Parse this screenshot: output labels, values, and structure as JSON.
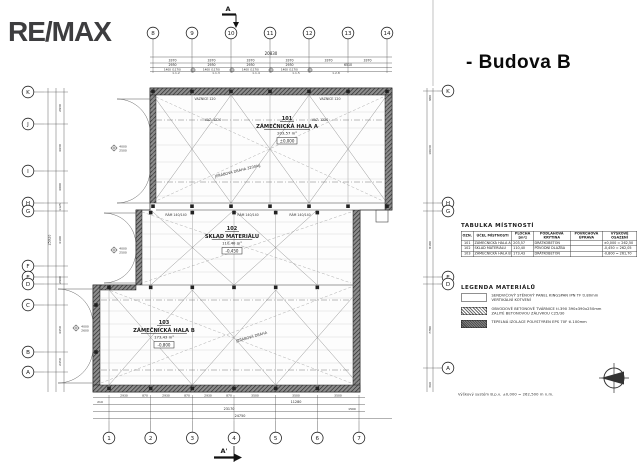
{
  "logo": {
    "text": "RE/MAX"
  },
  "title": "- Budova B",
  "note": "Výškový systém B.p.v. ±0,000 = 262,500 m n.m.",
  "plan": {
    "section_marker_top": "A",
    "section_marker_bottom": "A'",
    "axes_top": [
      "8",
      "9",
      "10",
      "11",
      "12",
      "13",
      "14"
    ],
    "axes_bottom": [
      "1",
      "2",
      "3",
      "4",
      "5",
      "6",
      "7"
    ],
    "axes_left": [
      "K",
      "J",
      "I",
      "H",
      "G",
      "F",
      "E",
      "D",
      "C",
      "B",
      "A"
    ],
    "axes_right": [
      "K",
      "H",
      "G",
      "E",
      "D",
      "A"
    ],
    "rooms": [
      {
        "number": "101",
        "name": "ZÁMEČNICKÁ HALA A",
        "area": "203,57 m²",
        "level": "±0,000"
      },
      {
        "number": "102",
        "name": "SKLAD MATERIÁLU",
        "area": "110,40 m²",
        "level": "-0,450"
      },
      {
        "number": "103",
        "name": "ZÁMEČNICKÁ HALA B",
        "area": "173,43 m²",
        "level": "-0,800"
      }
    ],
    "annotations": [
      "JEŘÁBOVÁ DRÁHA 3200kg",
      "JEŘÁBOVÁ DRÁHA",
      "VAZ. 1220",
      "VAZ. 1220",
      "RÁM 140/140",
      "RÁM 140/140",
      "RÁM 140/140",
      "VAZNICE 120",
      "VAZNICE 120"
    ],
    "tags": [
      "1.1.2",
      "1.1.3",
      "1.1.4",
      "1.1.5",
      "1.2.8"
    ],
    "level_markers": [
      {
        "top": "4000",
        "bottom": "2500"
      },
      {
        "top": "4000",
        "bottom": "2500"
      },
      {
        "top": "4000",
        "bottom": "2600"
      }
    ],
    "dims_top": {
      "total": "20830",
      "row1": [
        "3370",
        "3370",
        "3370",
        "3370",
        "3370",
        "3370"
      ],
      "row2": [
        "2930",
        "2930",
        "2930",
        "2930",
        "6510"
      ],
      "row3": [
        "1400 (1170)",
        "1400 (1170)",
        "1400 (1170)",
        "1400 (1170)"
      ]
    },
    "dims_bottom": {
      "row1": [
        "2930",
        "870",
        "2930",
        "870",
        "2930",
        "870",
        "3500",
        "3500",
        "3500"
      ],
      "row2_total": "11280",
      "row2_left": "210",
      "row2_right": "1500",
      "row3_total": "23170",
      "row4_total": "24750"
    },
    "dims_left": [
      "2930",
      "4630",
      "4000",
      "1125",
      "4100",
      "2900",
      "4450",
      "2450"
    ],
    "dims_left_total": "25920",
    "dims_right": [
      "980",
      "10630",
      "8180",
      "7780",
      "360"
    ]
  },
  "room_table": {
    "title": "TABULKA MÍSTNOSTÍ",
    "headers": [
      "OZN.",
      "ÚČEL MÍSTNOSTI",
      "PLOCHA [m²]",
      "PODLAHOVÁ KRYTINA",
      "POVRCHOVÁ ÚPRAVA",
      "VÝŠKOVÉ OSAZENÍ"
    ],
    "rows": [
      [
        "101",
        "ZÁMEČNICKÁ HALA A",
        "203,57",
        "DRÁTKOBETON",
        "",
        "±0,000 = 262,50"
      ],
      [
        "102",
        "SKLAD MATERIÁLU",
        "110,40",
        "PŮVODNÍ DLAŽBA",
        "",
        "-0,450 = 262,05"
      ],
      [
        "103",
        "ZÁMEČNICKÁ HALA B",
        "173,43",
        "DRÁTKOBETON",
        "",
        "-0,800 = 261,70"
      ]
    ]
  },
  "legend": {
    "title": "LEGENDA MATERIÁLŮ",
    "items": [
      {
        "swatch": "panel-swatch",
        "lines": [
          "SENDVIČOVÝ STĚNOVÝ PANEL KINGSPAN IPN TF tl.80mm",
          "VERTIKÁLNÍ KOTVENÍ"
        ]
      },
      {
        "swatch": "hatch-swatch",
        "lines": [
          "OBVODOVÉ BETONOVÉ TVÁRNICE tl.390 390x390x250mm",
          "ZALITÉ BETONOVOU ZÁLIVKOU C25/30"
        ]
      },
      {
        "swatch": "dark-swatch",
        "lines": [
          "TEPELNÁ IZOLACE POLYSTYREN EPS 70F tl.100mm"
        ]
      }
    ]
  },
  "compass": {
    "icon": "north-arrow-icon"
  }
}
